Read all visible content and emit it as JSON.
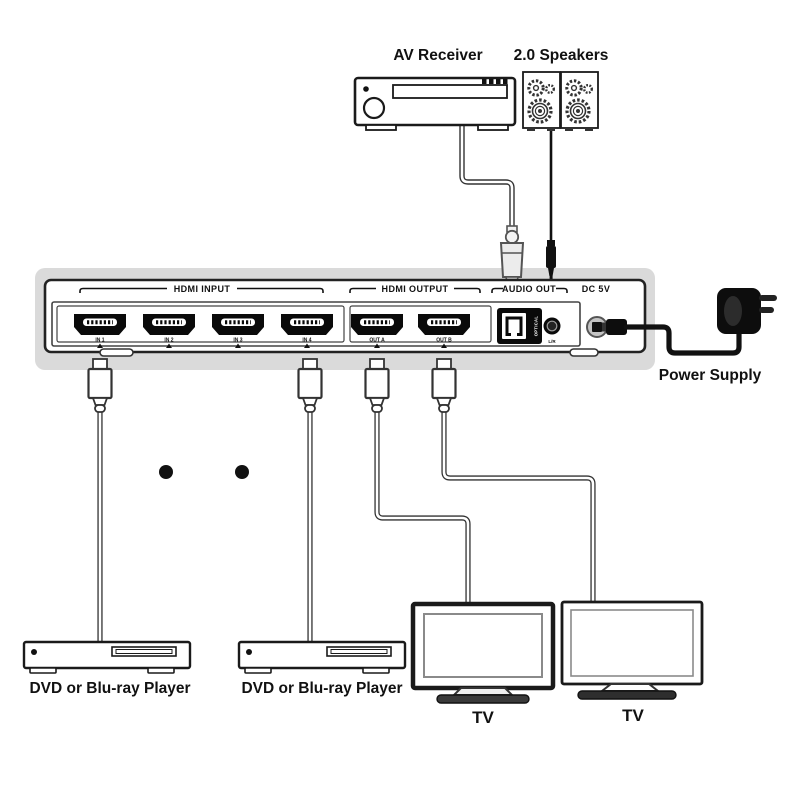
{
  "diagram": {
    "devices": {
      "av_receiver": {
        "label": "AV Receiver"
      },
      "speakers": {
        "label": "2.0 Speakers"
      },
      "power_supply": {
        "label": "Power Supply"
      },
      "dvd_player_1": {
        "label": "DVD or Blu-ray Player"
      },
      "dvd_player_2": {
        "label": "DVD or Blu-ray Player"
      },
      "tv_1": {
        "label": "TV"
      },
      "tv_2": {
        "label": "TV"
      }
    },
    "switch_panel": {
      "sections": {
        "hdmi_input": "HDMI INPUT",
        "hdmi_output": "HDMI OUTPUT",
        "audio_out": "AUDIO OUT",
        "dc_power": "DC 5V"
      },
      "ports": {
        "inputs": [
          "IN 1",
          "IN 2",
          "IN 3",
          "IN 4"
        ],
        "outputs": [
          "OUT A",
          "OUT B"
        ],
        "optical_label": "OPTICAL",
        "lr_label": "L/R"
      }
    },
    "colors": {
      "line": "#1a1a1a",
      "panel_glow": "#dadada",
      "cable_black": "#111111",
      "port_black": "#0a0a0a"
    }
  }
}
